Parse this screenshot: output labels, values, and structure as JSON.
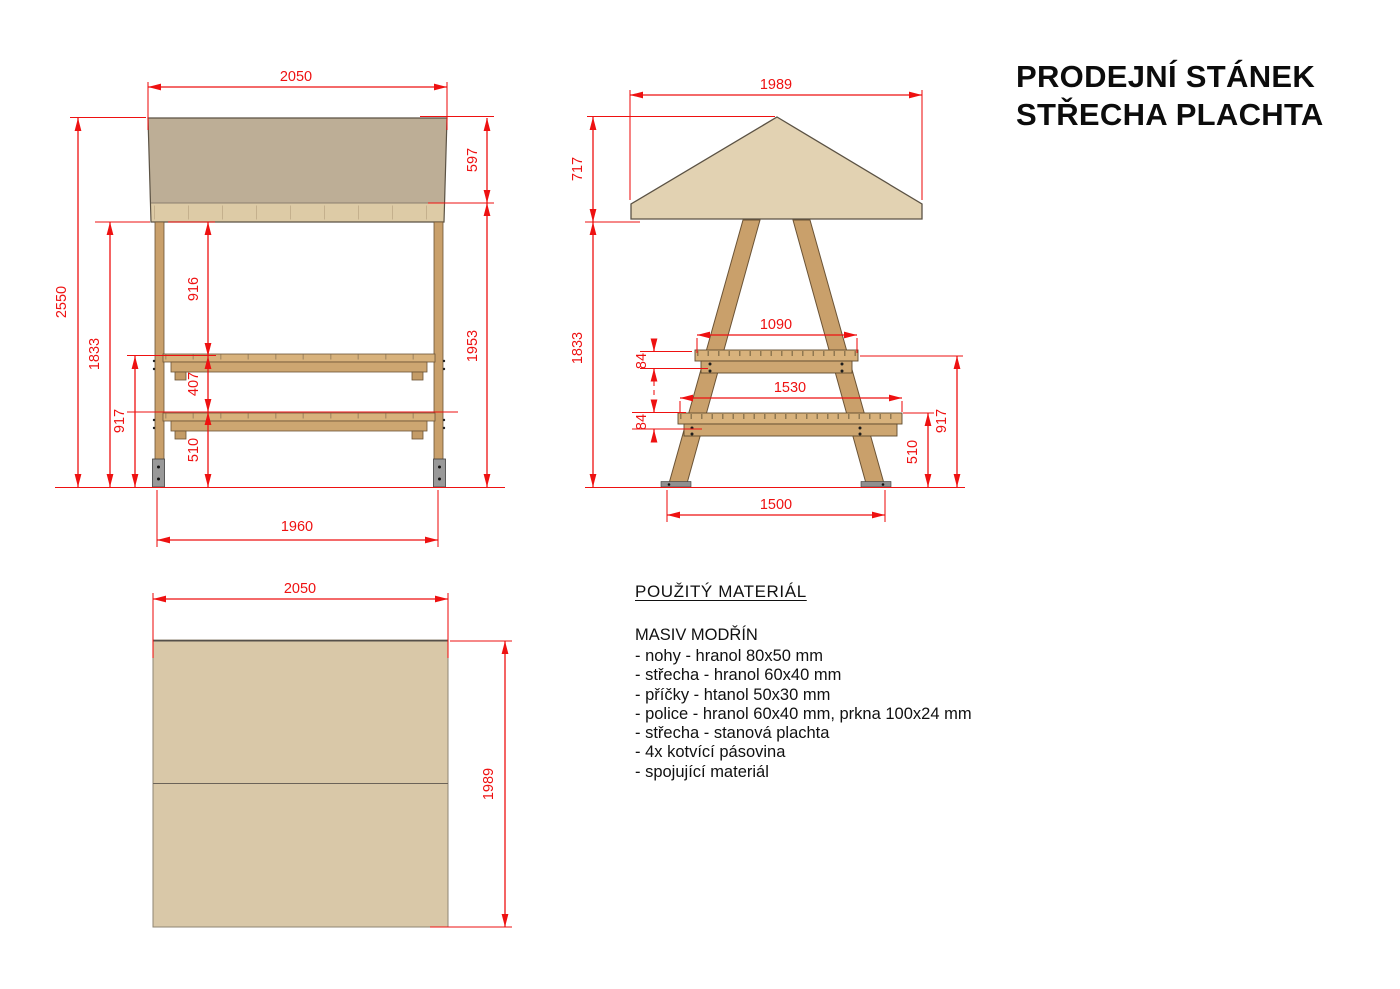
{
  "title": {
    "line1": "PRODEJNÍ STÁNEK",
    "line2": "STŘECHA PLACHTA"
  },
  "materials": {
    "heading": "POUŽITÝ MATERIÁL",
    "subheading": "MASIV MODŘÍN",
    "items": [
      "- nohy - hranol 80x50 mm",
      "- střecha - hranol 60x40 mm",
      "- příčky - htanol 50x30 mm",
      "- police - hranol 60x40 mm, prkna 100x24 mm",
      "- střecha - stanová plachta",
      "- 4x kotvící pásovina",
      "- spojující materiál"
    ]
  },
  "dims": {
    "front": {
      "roof_width": "2050",
      "canvas_height": "597",
      "total_height": "2550",
      "frame_height": "1833",
      "roof_to_shelf": "916",
      "shelf_gap": "407",
      "shelf_to_ground": "917",
      "lower_shelf_to_ground": "510",
      "under_canvas_height": "1953",
      "feet_span": "1960"
    },
    "side": {
      "roof_width": "1989",
      "roof_height": "717",
      "frame_height": "1833",
      "upper_shelf_length": "1090",
      "upper_shelf_thickness": "84",
      "lower_shelf_length": "1530",
      "lower_shelf_thickness": "84",
      "upper_shelf_height": "917",
      "lower_shelf_height": "510",
      "feet_span": "1500"
    },
    "plan": {
      "width": "2050",
      "depth": "1989"
    }
  },
  "colors": {
    "dimension_red": "#ee1111",
    "canvas_dark": "#bdae96",
    "canvas_light": "#e2d2b2",
    "wood_board": "#ddcba6",
    "plan_canvas": "#d9c8a8",
    "leg_wood": "#c9a06b",
    "shelf_wood": "#d8b27c",
    "metal": "#999999"
  }
}
